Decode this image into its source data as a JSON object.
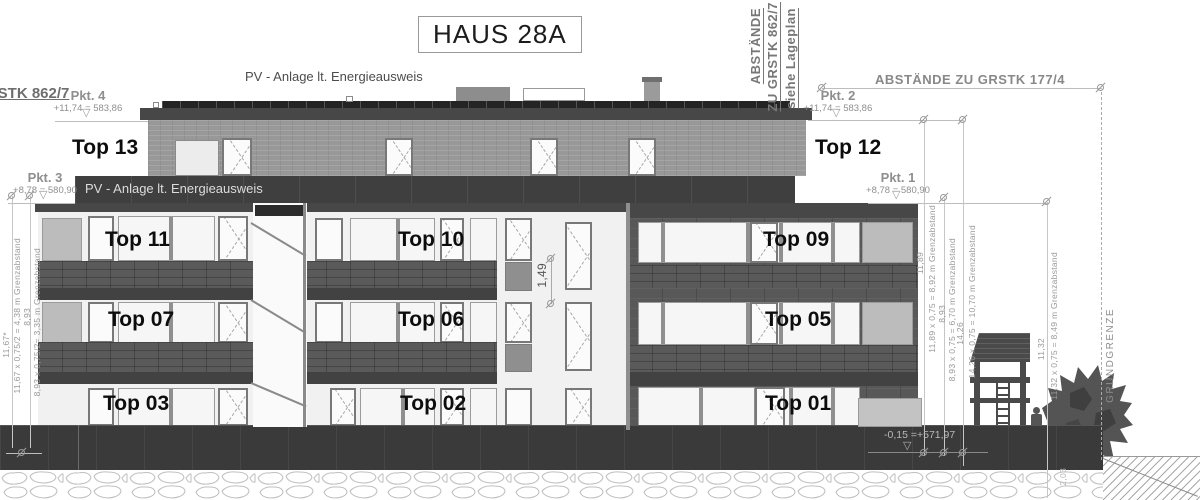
{
  "title": "HAUS 28A",
  "labels": {
    "pv_roof": "PV - Anlage lt. Energieausweis",
    "pv_band": "PV - Anlage lt. Energieausweis",
    "gstk_left": "GSTK 862/7",
    "abst_rot_1": "ABSTÄNDE",
    "abst_rot_2": "ZU GRSTK 862/7",
    "abst_rot_3": "siehe Lageplan",
    "abst_177": "ABSTÄNDE ZU GRSTK 177/4",
    "grundgrenze": "GRUNDGRENZE",
    "level_base": "-0,15 =+571,97",
    "dim_mid": "1,49",
    "dim_br": "2,03"
  },
  "points": {
    "pkt4": {
      "name": "Pkt. 4",
      "value": "+11,74 = 583,86"
    },
    "pkt3": {
      "name": "Pkt. 3",
      "value": "+8,78 = 580,90"
    },
    "pkt2": {
      "name": "Pkt. 2",
      "value": "+11,74 = 583,86"
    },
    "pkt1": {
      "name": "Pkt. 1",
      "value": "+8,78 = 580,90"
    }
  },
  "units": {
    "top13": "Top 13",
    "top12": "Top 12",
    "top11": "Top 11",
    "top10": "Top 10",
    "top09": "Top 09",
    "top07": "Top 07",
    "top06": "Top 06",
    "top05": "Top 05",
    "top03": "Top 03",
    "top02": "Top 02",
    "top01": "Top 01"
  },
  "dims_left": {
    "h1": "11,67*",
    "c1": "11,67 x 0,75/2 = 4,38 m Grenzabstand",
    "h2": "8,93",
    "c2": "8,93 x 0,75/2= 3,35 m Grenzabstand"
  },
  "dims_right": {
    "h1": "11,89",
    "c1": "11,89 x 0,75 = 8,92 m Grenzabstand",
    "h2": "8,93",
    "c2": "8,93 x 0,75 = 6,70 m Grenzabstand",
    "h3": "14,26",
    "c3": "14,26 x 0,75 = 10,70 m Grenzabstand",
    "h4": "11,32",
    "c4": "11,32 x 0,75 = 8,49 m Grenzabstand"
  },
  "icons": {
    "level_marker": "▽"
  },
  "colors": {
    "band_dark": "#3f3f3f",
    "cladding": "#585858",
    "attic_wall": "#989898",
    "base_wall": "#3a3a3a",
    "panel_light": "#bcbcbc",
    "accent_panel": "#8f8f8f",
    "dim_gray": "#9a9a9a",
    "pv_strip": "#242424"
  }
}
